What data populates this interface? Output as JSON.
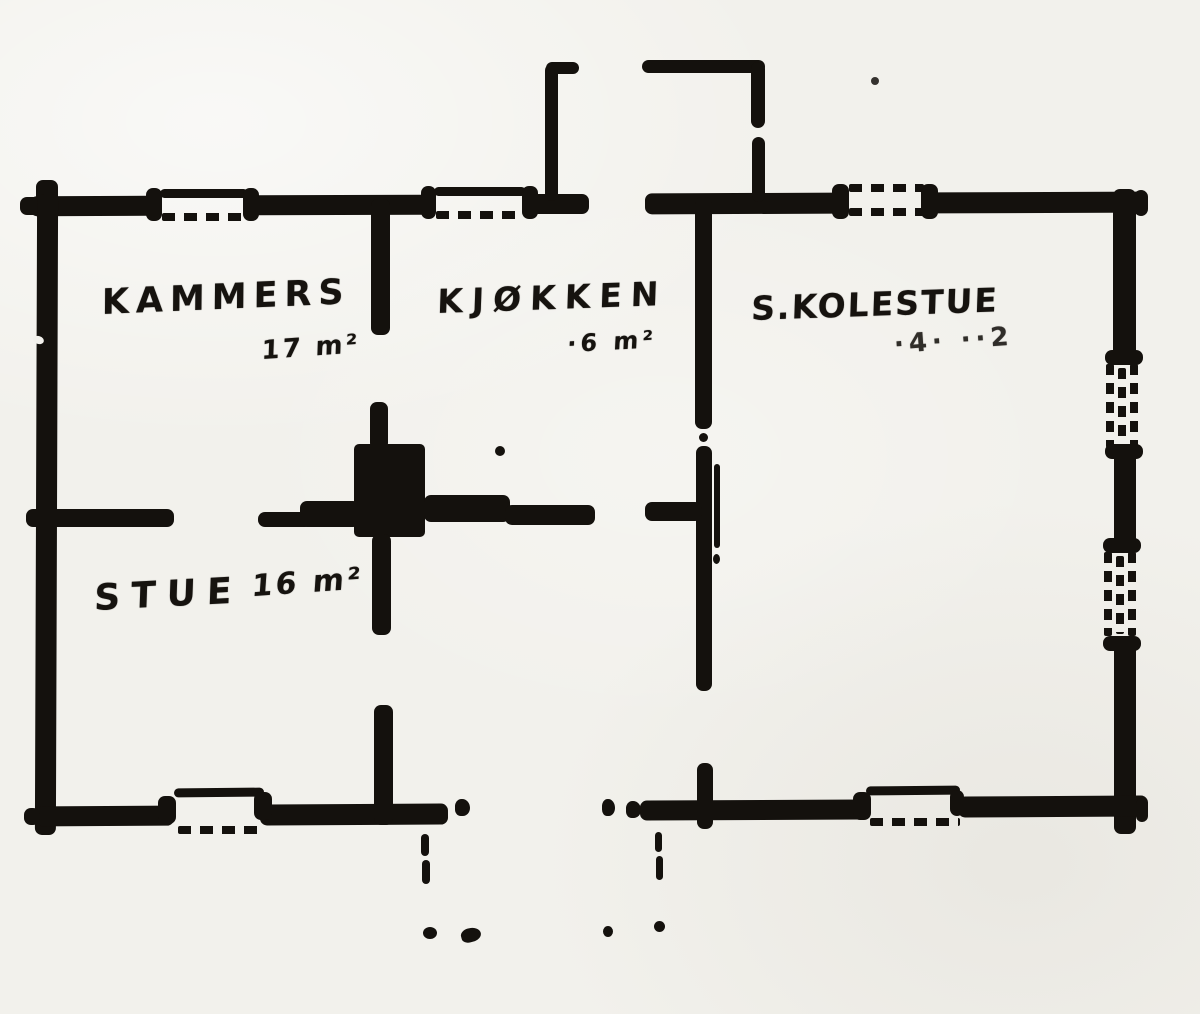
{
  "document": {
    "kind": "hand-drawn floor plan scan"
  },
  "colors": {
    "paper": "#f2f1ec",
    "ink": "#14110d"
  },
  "rooms": [
    {
      "name": "KAMMERS",
      "area": "17 m²"
    },
    {
      "name": "KJØKKEN",
      "area": "·6 m²"
    },
    {
      "name": "S.KOLESTUE",
      "area": "·4·  ··2"
    },
    {
      "name": "STUE",
      "area": "16 m²"
    }
  ]
}
